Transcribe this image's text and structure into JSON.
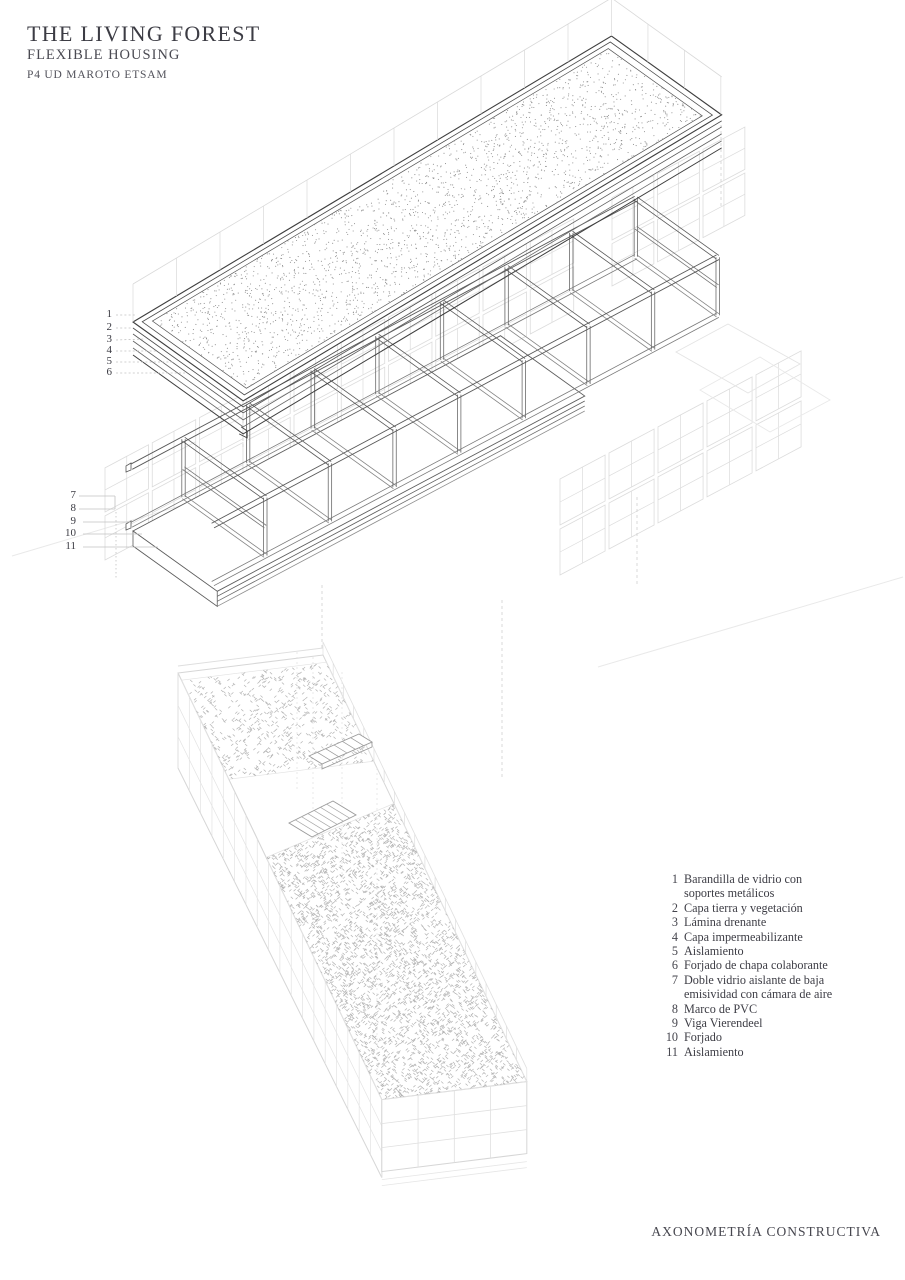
{
  "header": {
    "title": "THE LIVING FOREST",
    "subtitle": "FLEXIBLE HOUSING",
    "project": "P4 UD MAROTO ETSAM"
  },
  "footer": {
    "label": "AXONOMETRÍA CONSTRUCTIVA"
  },
  "callouts": {
    "roof": [
      "1",
      "2",
      "3",
      "4",
      "5",
      "6"
    ],
    "truss": [
      "7",
      "8",
      "9",
      "10",
      "11"
    ]
  },
  "legend": {
    "items": [
      {
        "num": "1",
        "label": "Barandilla de vidrio con\nsoportes metálicos"
      },
      {
        "num": "2",
        "label": "Capa tierra y vegetación"
      },
      {
        "num": "3",
        "label": "Lámina drenante"
      },
      {
        "num": "4",
        "label": "Capa impermeabilizante"
      },
      {
        "num": "5",
        "label": "Aislamiento"
      },
      {
        "num": "6",
        "label": "Forjado de chapa colaborante"
      },
      {
        "num": "7",
        "label": "Doble vidrio aislante de baja\nemisividad con cámara de aire"
      },
      {
        "num": "8",
        "label": "Marco de PVC"
      },
      {
        "num": "9",
        "label": "Viga Vierendeel"
      },
      {
        "num": "10",
        "label": "Forjado"
      },
      {
        "num": "11",
        "label": "Aislamiento"
      }
    ]
  },
  "colors": {
    "ink": "#3c3c44",
    "line_dark": "#3e3e3e",
    "line_main": "#585858",
    "line_mid": "#7a7a7a",
    "post": "#6b6b6b",
    "ghost": "#dcdcdc",
    "faint": "#e9e9e9",
    "stipple": "#8f8f8f",
    "terrace": "#b5b5b5",
    "leader": "#c2c2c2",
    "stair": "#9a9a9a",
    "bldg": "#d6d6d6"
  }
}
